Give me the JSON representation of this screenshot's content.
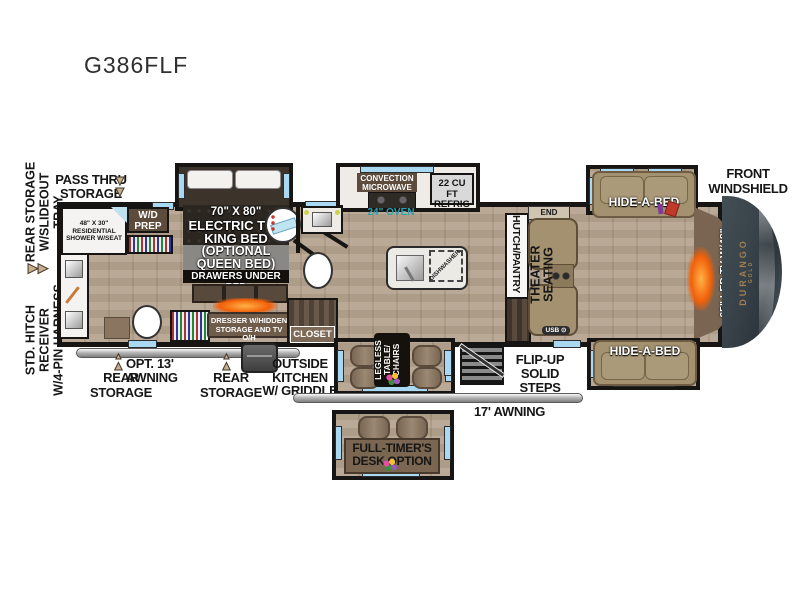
{
  "title": "G386FLF",
  "colors": {
    "wall": "#171513",
    "floor": "#b5a48f",
    "window_blue": "#a9d9f2",
    "sofa_tan": "#a3916f",
    "fireplace_orange": "#f2600a",
    "oven_teal": "#2f9fae",
    "cap_gray": "#39434a",
    "brand_gold": "#a07e50"
  },
  "icons": {
    "arrow_right": "▶▶",
    "arrow_down": "▼",
    "usb_port": "⊙"
  },
  "left_margin": {
    "rear_storage_line1": "REAR STORAGE",
    "rear_storage_line2": "W/SLIDEOUT TRAY",
    "hitch_line1": "STD. HITCH RECEIVER",
    "hitch_line2": "W/4-PIN HARNESS"
  },
  "top_labels": {
    "pass_thru_line1": "PASS THRU",
    "pass_thru_line2": "STORAGE",
    "front_windshield_line1": "FRONT",
    "front_windshield_line2": "WINDSHIELD"
  },
  "bedroom": {
    "bed_size": "70\" X 80\"",
    "bed_line2": "ELECTRIC TILT",
    "bed_line3": "KING BED",
    "optional_line1": "(OPTIONAL",
    "optional_line2": "QUEEN BED)",
    "drawers": "DRAWERS UNDER BED",
    "dresser_line1": "DRESSER W/HIDDEN",
    "dresser_line2": "STORAGE AND TV O/H",
    "wd_line1": "W/D",
    "wd_line2": "PREP",
    "shower_line1": "48\" X 30\"",
    "shower_line2": "RESIDENTIAL",
    "shower_line3": "SHOWER W/SEAT"
  },
  "kitchen": {
    "microwave_line1": "CONVECTION",
    "microwave_line2": "MICROWAVE",
    "refrig_line1": "22 CU FT",
    "refrig_line2": "REFRIG",
    "oven": "24\" OVEN",
    "dishwasher": "DISHWASHER,",
    "hutch": "HUTCH/PANTRY",
    "closet": "CLOSET"
  },
  "living": {
    "end_table": "END TABLE",
    "usb_label": "USB",
    "theater_line1": "THEATER",
    "theater_line2": "SEATING",
    "hide_a_bed_top": "HIDE-A-BED",
    "hide_a_bed_bottom": "HIDE-A-BED",
    "tv_fireplace": "65\" LED TV W/48\" FIREPLACE"
  },
  "exterior": {
    "awning13": "OPT. 13' AWNING",
    "rear_storage1_line1": "REAR",
    "rear_storage1_line2": "STORAGE",
    "rear_storage2_line1": "REAR",
    "rear_storage2_line2": "STORAGE",
    "outside_kitchen_line1": "OUTSIDE",
    "outside_kitchen_line2": "KITCHEN",
    "outside_kitchen_line3": "W/ GRIDDLE",
    "steps_line1": "FLIP-UP",
    "steps_line2": "SOLID STEPS",
    "awning17": "17' AWNING",
    "dinette_line1": "LEGLESS",
    "dinette_line2": "TABLE/",
    "dinette_line3": "CHAIRS",
    "desk_line1": "FULL-TIMER'S",
    "desk_line2": "DESK OPTION"
  },
  "brand": {
    "name": "DURANGO",
    "sub": "GOLD"
  }
}
